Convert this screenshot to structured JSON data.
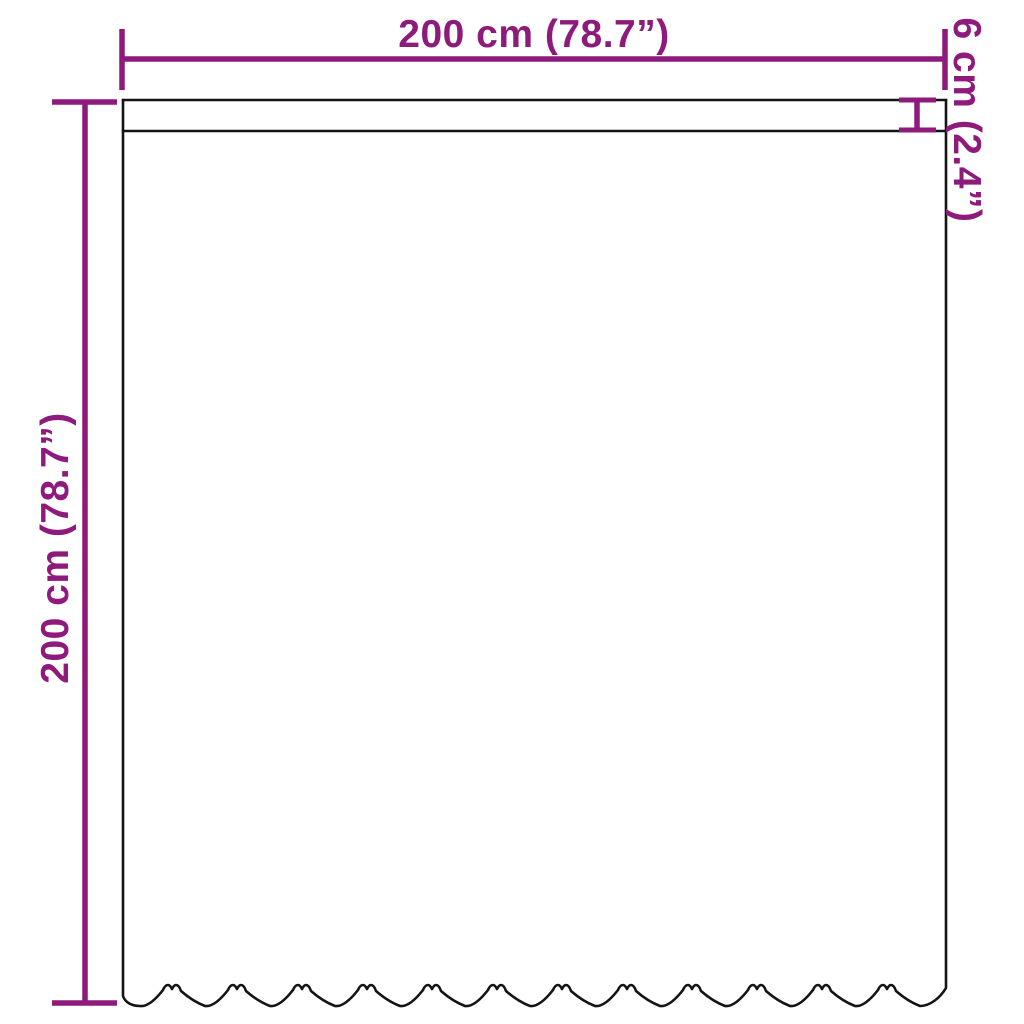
{
  "figure": {
    "background": "#ffffff",
    "outline_color": "#141414",
    "dimension_color": "#8e1a7c",
    "width_label": "200 cm (78.7”)",
    "height_label": "200 cm (78.7”)",
    "header_height_label": "6 cm (2.4”)"
  }
}
